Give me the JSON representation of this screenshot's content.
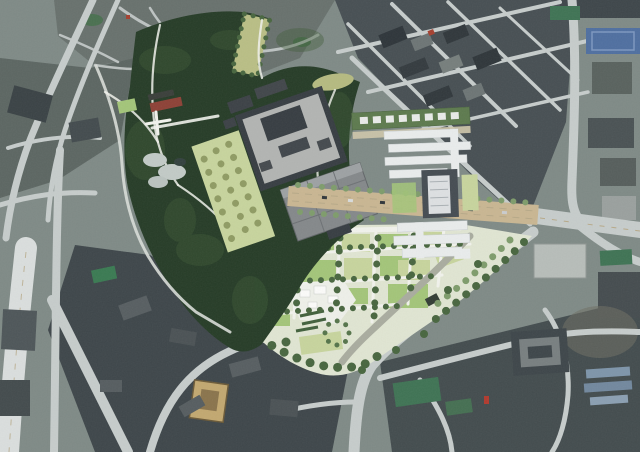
{
  "image": {
    "type": "aerial-master-plan",
    "description": "Aerial satellite photograph of a dense city center with a landscape-architecture master plan rendering overlaid: a forested hill and park site containing a palace complex with gravel courtyards, long white museum buildings, a beige tree-lined boulevard, lawns, plazas and tree groves, surrounded by urban blocks and road network",
    "width_px": 640,
    "height_px": 452
  },
  "palette": {
    "sat-base": "#7f8a86",
    "road-light": "#c6cccb",
    "road-bright": "#dadedd",
    "block-dark": "#3e464a",
    "block-mid": "#59625e",
    "hanok": "#68716d",
    "ne-district": "#474f53",
    "forest": "#263c27",
    "forest-light": "#3f5c37",
    "meadow": "#b9be85",
    "lawn": "#c7d49d",
    "lawn-bright": "#a3c579",
    "park-base": "#e0e5d2",
    "path-white": "#f1f2ec",
    "tree-dark": "#48663f",
    "tree-soft": "#7e9c6b",
    "olive-tree": "#8f9b63",
    "palace-roof": "#373d42",
    "courtyard": "#b2b4b2",
    "gravel": "#84888a",
    "bldg-white": "#e9ecec",
    "boulevard": "#c9b692",
    "lane-line": "#b7a988",
    "red-roof": "#8d4136",
    "blue-court": "#4f6fa0",
    "green-court": "#3f7354",
    "tan-house": "#c2a870",
    "shed-blue": "#7e95aa",
    "gray-walk": "#a9ac9f",
    "white-paving": "#eef0e9"
  },
  "regions": [
    {
      "id": "hanok-village",
      "note": "dense low-rise historic district, top-left"
    },
    {
      "id": "forest-hill",
      "note": "dark wooded hill wrapping the plan site"
    },
    {
      "id": "meadow-clearing",
      "note": "olive meadow strips inside the forest"
    },
    {
      "id": "palace-complex",
      "note": "dark-roofed enclosure with gravel courtyards, center"
    },
    {
      "id": "museum-complex",
      "note": "white bar buildings and central tower, center-right"
    },
    {
      "id": "boulevard",
      "note": "beige tree-lined avenue crossing the site"
    },
    {
      "id": "central-park",
      "note": "lawn grid, white paths, pavilion plaza, bottom-center"
    },
    {
      "id": "northeast-district",
      "note": "diagonal street grid of city blocks"
    },
    {
      "id": "sports-courts",
      "note": "blue and green courts, top-right"
    },
    {
      "id": "southern-blocks",
      "note": "dark urban superblocks, bottom"
    }
  ]
}
